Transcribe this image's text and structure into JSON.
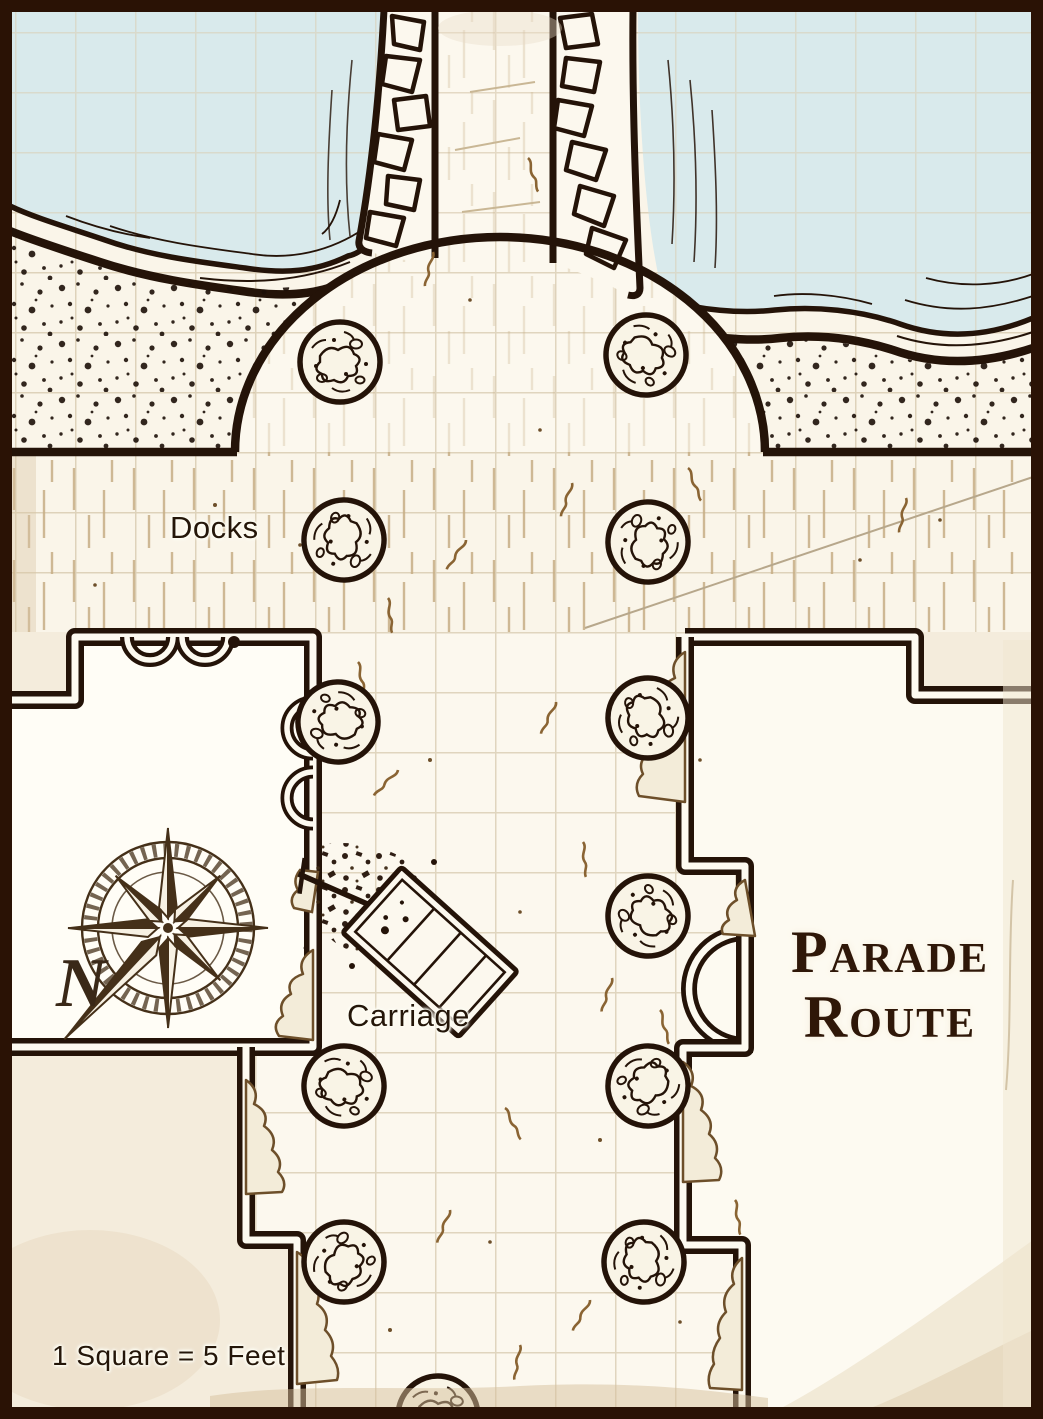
{
  "title": {
    "line1": "Parade",
    "line2": "Route"
  },
  "labels": {
    "docks": "Docks",
    "carriage": "Carriage",
    "scale": "1 Square = 5 Feet",
    "compass_north": "N"
  },
  "colors": {
    "ink": "#241308",
    "frame": "#2a1205",
    "paper": "#f4ecdc",
    "map_paper": "#fcf8ee",
    "building_interior": "#fffdf6",
    "water": "#d9eaec",
    "grid_line": "#d9ccb2",
    "accent_brown": "#8a6433",
    "stain_tan": "#d9c6a2"
  }
}
